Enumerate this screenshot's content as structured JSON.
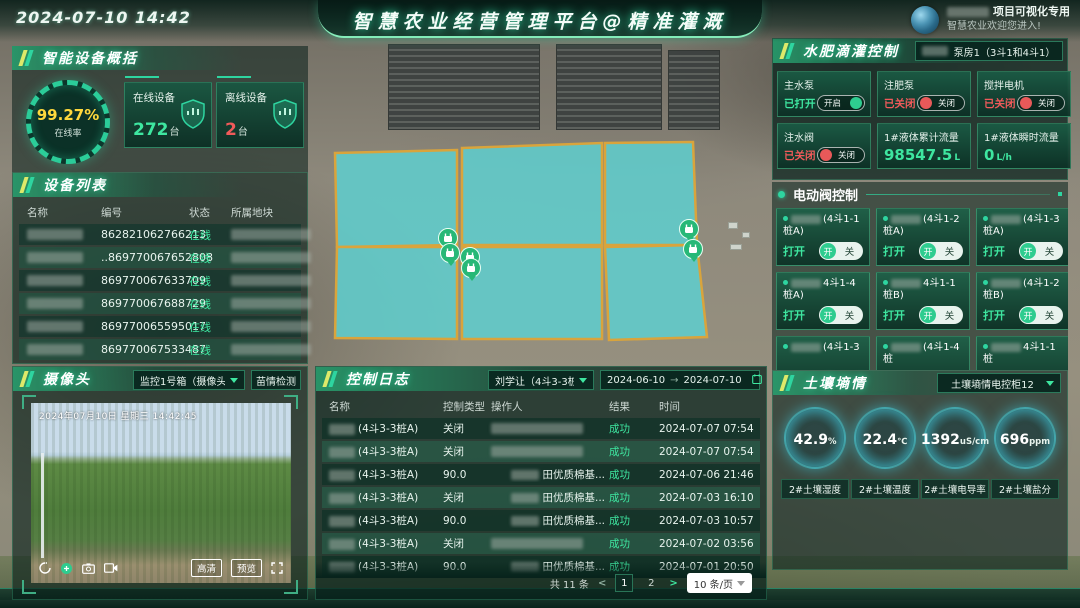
{
  "header": {
    "datetime": "2024-07-10 14:42",
    "title": "智慧农业经营管理平台@精准灌溉",
    "user_line1": "项目可视化专用",
    "user_line2": "智慧农业欢迎您进入!"
  },
  "device_overview": {
    "section_title": "智能设备概括",
    "online_rate": "99.27%",
    "online_rate_label": "在线率",
    "cards": [
      {
        "label": "在线设备",
        "value": "272",
        "unit": "台",
        "color": "#3ee6a0",
        "icon": "online-shield-icon"
      },
      {
        "label": "离线设备",
        "value": "2",
        "unit": "台",
        "color": "#f05a5a",
        "icon": "offline-shield-icon"
      }
    ]
  },
  "device_list": {
    "section_title": "设备列表",
    "columns": [
      "名称",
      "编号",
      "状态",
      "所属地块"
    ],
    "rows": [
      {
        "code": "862821062766213",
        "status": "在线"
      },
      {
        "code": "..869770067652808",
        "status": "在线"
      },
      {
        "code": "869770067633709",
        "status": "在线"
      },
      {
        "code": "869770067688729",
        "status": "在线"
      },
      {
        "code": "869770065595017",
        "status": "在线"
      },
      {
        "code": "869770067533487",
        "status": "在线"
      }
    ]
  },
  "camera": {
    "section_title": "摄像头",
    "selector": "监控1号箱（摄像头2...",
    "detect_button": "苗情检测",
    "overlay_timestamp": "2024年07月10日 星期三 14:42:45",
    "hd_button": "高清",
    "preview_button": "预览"
  },
  "control_log": {
    "section_title": "控制日志",
    "selector": "刘学让（4斗3-3桩A）",
    "date_from": "2024-06-10",
    "date_arrow": "→",
    "date_to": "2024-07-10",
    "columns": [
      "名称",
      "控制类型",
      "操作人",
      "结果",
      "时间"
    ],
    "rows": [
      {
        "name": "(4斗3-3桩A)",
        "type": "关闭",
        "operator": "",
        "result": "成功",
        "time": "2024-07-07 07:54"
      },
      {
        "name": "(4斗3-3桩A)",
        "type": "关闭",
        "operator": "",
        "result": "成功",
        "time": "2024-07-07 07:54"
      },
      {
        "name": "(4斗3-3桩A)",
        "type": "90.0",
        "operator": "田优质棉基...",
        "result": "成功",
        "time": "2024-07-06 21:46"
      },
      {
        "name": "(4斗3-3桩A)",
        "type": "关闭",
        "operator": "田优质棉基...",
        "result": "成功",
        "time": "2024-07-03 16:10"
      },
      {
        "name": "(4斗3-3桩A)",
        "type": "90.0",
        "operator": "田优质棉基...",
        "result": "成功",
        "time": "2024-07-03 10:57"
      },
      {
        "name": "(4斗3-3桩A)",
        "type": "关闭",
        "operator": "",
        "result": "成功",
        "time": "2024-07-02 03:56"
      },
      {
        "name": "(4斗3-3桩A)",
        "type": "90.0",
        "operator": "田优质棉基...",
        "result": "成功",
        "time": "2024-07-01 20:50"
      }
    ],
    "pagination": {
      "total": "共 11 条",
      "prev": "<",
      "pages": [
        "1",
        "2"
      ],
      "active": "1",
      "next": ">",
      "per_page": "10 条/页"
    }
  },
  "irrigation": {
    "section_title": "水肥滴灌控制",
    "selector": "泵房1（3斗1和4斗1）",
    "switches": [
      {
        "label": "主水泵",
        "status": "已打开",
        "on": true,
        "toggle_text": "开启"
      },
      {
        "label": "注肥泵",
        "status": "已关闭",
        "on": false,
        "toggle_text": "关闭"
      },
      {
        "label": "搅拌电机",
        "status": "已关闭",
        "on": false,
        "toggle_text": "关闭"
      },
      {
        "label": "注水阀",
        "status": "已关闭",
        "on": false,
        "toggle_text": "关闭"
      }
    ],
    "meters": [
      {
        "label": "1#液体累计流量",
        "value": "98547.5",
        "unit": "L"
      },
      {
        "label": "1#液体瞬时流量",
        "value": "0",
        "unit": "L/h"
      }
    ]
  },
  "valve_control": {
    "section_title": "电动阀控制",
    "open_status_label": "打开",
    "on_label": "开",
    "off_label": "关",
    "valves": [
      {
        "name": "(4斗1-1桩A)",
        "status": "打开",
        "partial": false
      },
      {
        "name": "(4斗1-2桩A)",
        "status": "打开",
        "partial": false
      },
      {
        "name": "(4斗1-3桩A)",
        "status": "打开",
        "partial": false
      },
      {
        "name": "4斗1-4桩A)",
        "status": "打开",
        "partial": false
      },
      {
        "name": "4斗1-1桩B)",
        "status": "打开",
        "partial": false
      },
      {
        "name": "(4斗1-2桩B)",
        "status": "打开",
        "partial": false
      },
      {
        "name": "(4斗1-3",
        "status": "打开",
        "partial": true
      },
      {
        "name": "(4斗1-4桩",
        "status": "打开",
        "partial": true
      },
      {
        "name": "4斗1-1桩",
        "status": "打开",
        "partial": true
      }
    ]
  },
  "soil": {
    "section_title": "土壤墒情",
    "selector": "土壤墒情电控柜12",
    "gauges": [
      {
        "value": "42.9",
        "unit": "%",
        "label": "2#土壤湿度"
      },
      {
        "value": "22.4",
        "unit": "℃",
        "label": "2#土壤温度"
      },
      {
        "value": "1392",
        "unit": "uS/cm",
        "label": "2#土壤电导率"
      },
      {
        "value": "696",
        "unit": "ppm",
        "label": "2#土壤盐分"
      }
    ]
  },
  "map": {
    "field_fill": "#5ecfcf",
    "field_stroke": "#d9a43c",
    "marker_color": "#27b877",
    "fields": [
      "10,23 132,20 132,115 12,117",
      "137,18 277,13 277,115 137,115",
      "280,13 368,12 372,115 280,115",
      "12,117 132,117 132,209 10,208",
      "137,117 277,117 277,209 137,209",
      "280,117 372,115 382,207 284,210"
    ],
    "markers": [
      {
        "x": 448,
        "y": 238
      },
      {
        "x": 450,
        "y": 253
      },
      {
        "x": 470,
        "y": 257
      },
      {
        "x": 471,
        "y": 268
      },
      {
        "x": 689,
        "y": 229
      },
      {
        "x": 693,
        "y": 249
      }
    ]
  },
  "colors": {
    "accent": "#2ed5a0",
    "green_text": "#3ee6a0",
    "red": "#f05a5a",
    "yellow": "#ffd83d"
  }
}
